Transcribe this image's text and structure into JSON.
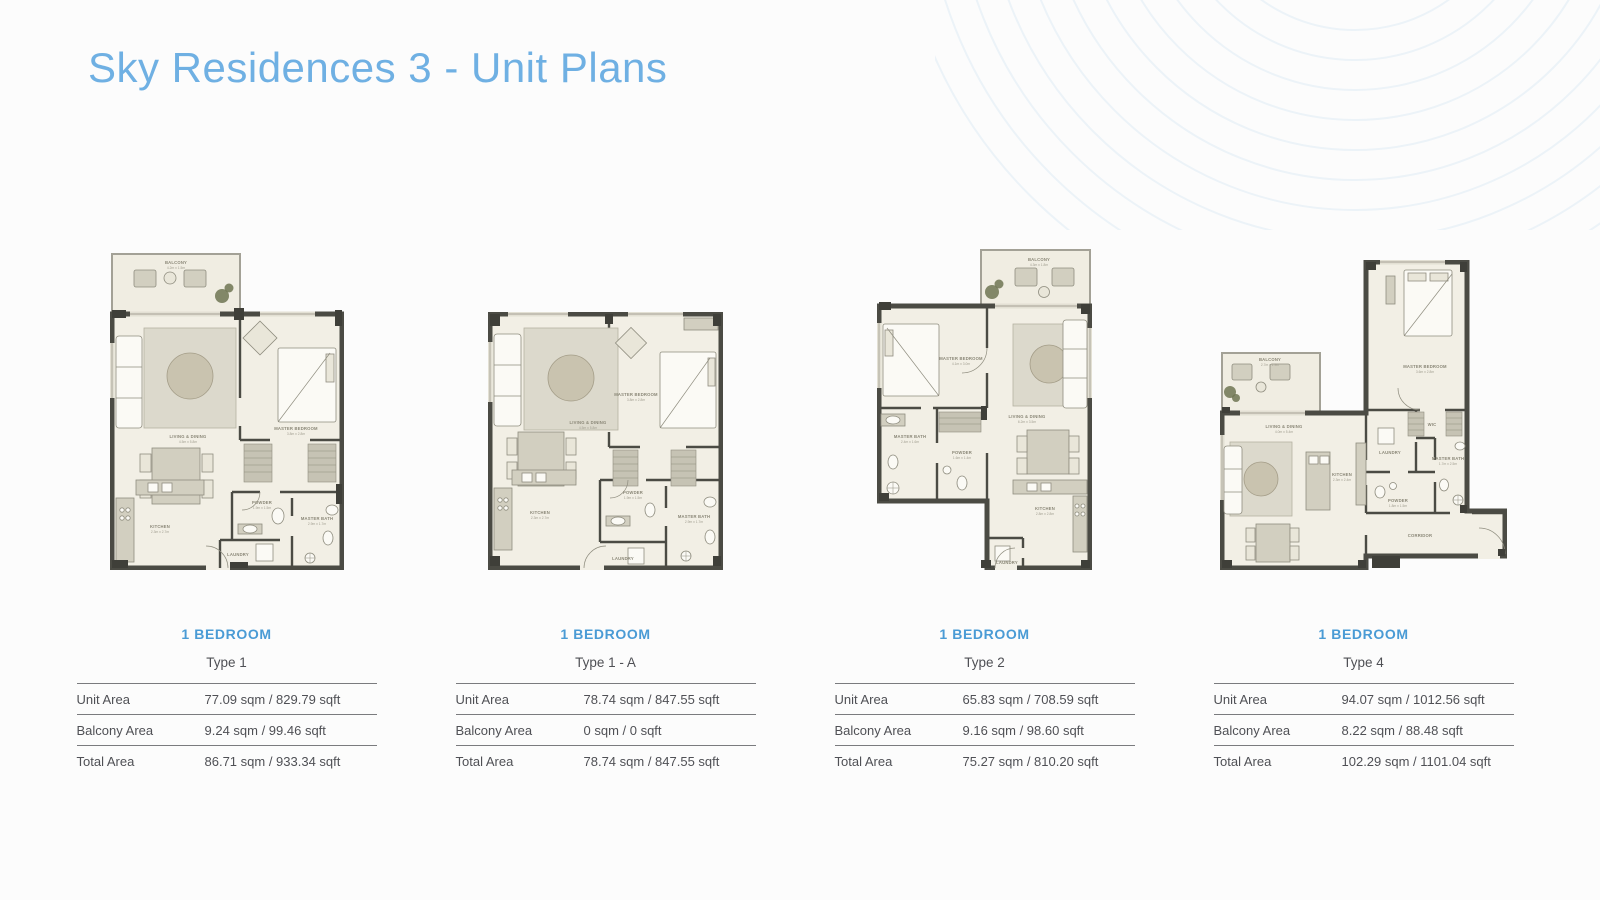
{
  "page": {
    "title": "Sky Residences 3 - Unit Plans"
  },
  "colors": {
    "title_blue": "#6fb0e3",
    "accent_blue": "#4a9bd5",
    "wall": "#4b4b44",
    "floor": "#f2efe5",
    "table_line": "#7a7b7e",
    "text": "#4f5055"
  },
  "units": [
    {
      "bedroom_label": "1 BEDROOM",
      "type": "Type 1",
      "rows": [
        {
          "label": "Unit Area",
          "value": "77.09 sqm / 829.79 sqft"
        },
        {
          "label": "Balcony Area",
          "value": "9.24 sqm / 99.46 sqft"
        },
        {
          "label": "Total Area",
          "value": "86.71 sqm / 933.34 sqft"
        }
      ],
      "rooms": {
        "balcony": {
          "name": "BALCONY",
          "dim": "4.2m x 1.5m"
        },
        "living": {
          "name": "LIVING & DINING",
          "dim": "4.5m x 5.8m"
        },
        "master": {
          "name": "MASTER BEDROOM",
          "dim": "3.8m x 2.8m"
        },
        "kitchen": {
          "name": "KITCHEN",
          "dim": "2.3m x 2.7m"
        },
        "powder": {
          "name": "POWDER",
          "dim": "1.9m x 1.5m"
        },
        "bath": {
          "name": "MASTER BATH",
          "dim": "2.9m x 1.7m"
        },
        "laundry": {
          "name": "LAUNDRY"
        }
      }
    },
    {
      "bedroom_label": "1 BEDROOM",
      "type": "Type 1 - A",
      "rows": [
        {
          "label": "Unit Area",
          "value": "78.74 sqm / 847.55 sqft"
        },
        {
          "label": "Balcony Area",
          "value": "0 sqm / 0 sqft"
        },
        {
          "label": "Total Area",
          "value": "78.74 sqm / 847.55 sqft"
        }
      ],
      "rooms": {
        "living": {
          "name": "LIVING & DINING",
          "dim": "4.5m x 5.8m"
        },
        "master": {
          "name": "MASTER BEDROOM",
          "dim": "3.8m x 2.8m"
        },
        "kitchen": {
          "name": "KITCHEN",
          "dim": "2.3m x 2.7m"
        },
        "powder": {
          "name": "POWDER",
          "dim": "1.9m x 1.5m"
        },
        "bath": {
          "name": "MASTER BATH",
          "dim": "2.9m x 1.7m"
        },
        "laundry": {
          "name": "LAUNDRY"
        }
      }
    },
    {
      "bedroom_label": "1 BEDROOM",
      "type": "Type 2",
      "rows": [
        {
          "label": "Unit Area",
          "value": "65.83 sqm / 708.59 sqft"
        },
        {
          "label": "Balcony Area",
          "value": "9.16 sqm / 98.60 sqft"
        },
        {
          "label": "Total Area",
          "value": "75.27 sqm / 810.20 sqft"
        }
      ],
      "rooms": {
        "balcony": {
          "name": "BALCONY",
          "dim": "4.3m x 1.8m"
        },
        "master": {
          "name": "MASTER BEDROOM",
          "dim": "4.1m x 3.0m"
        },
        "bath": {
          "name": "MASTER BATH",
          "dim": "2.4m x 1.6m"
        },
        "powder": {
          "name": "POWDER",
          "dim": "1.6m x 1.4m"
        },
        "living": {
          "name": "LIVING & DINING",
          "dim": "6.2m x 3.5m"
        },
        "kitchen": {
          "name": "KITCHEN",
          "dim": "2.8m x 2.8m"
        },
        "laundry": {
          "name": "LAUNDRY"
        }
      }
    },
    {
      "bedroom_label": "1 BEDROOM",
      "type": "Type 4",
      "rows": [
        {
          "label": "Unit Area",
          "value": "94.07 sqm / 1012.56 sqft"
        },
        {
          "label": "Balcony Area",
          "value": "8.22 sqm / 88.48 sqft"
        },
        {
          "label": "Total Area",
          "value": "102.29 sqm / 1101.04 sqft"
        }
      ],
      "rooms": {
        "balcony": {
          "name": "BALCONY",
          "dim": "2.7m x 1.9m"
        },
        "master": {
          "name": "MASTER BEDROOM",
          "dim": "3.6m x 2.8m"
        },
        "wic": {
          "name": "WIC"
        },
        "living": {
          "name": "LIVING & DINING",
          "dim": "4.0m x 5.4m"
        },
        "kitchen": {
          "name": "KITCHEN",
          "dim": "2.3m x 2.4m"
        },
        "laundry": {
          "name": "LAUNDRY"
        },
        "powder": {
          "name": "POWDER",
          "dim": "1.8m x 1.5m"
        },
        "bath": {
          "name": "MASTER BATH",
          "dim": "1.7m x 2.5m"
        },
        "corridor": {
          "name": "CORRIDOR"
        }
      }
    }
  ]
}
